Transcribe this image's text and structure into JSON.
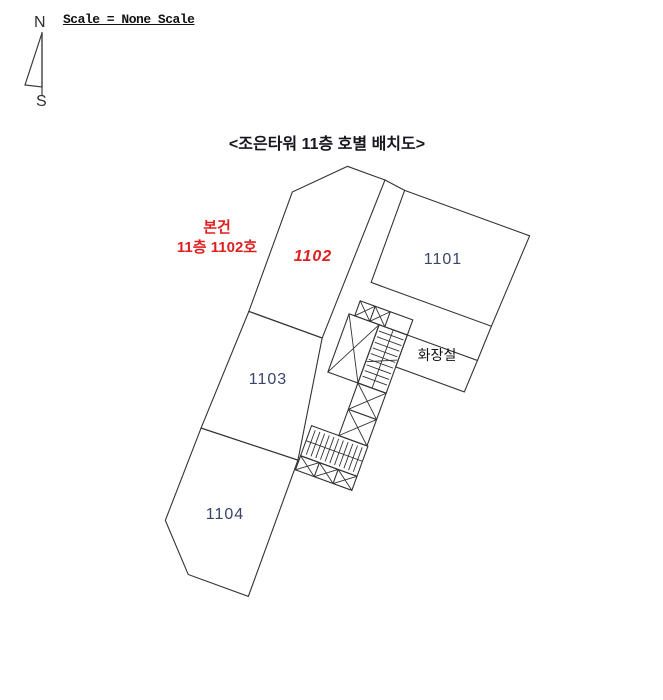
{
  "colors": {
    "line": "#333333",
    "hatch_red": "#e46060",
    "annotation_red": "#e01f1f",
    "unit_label": "#3a4469",
    "title_text": "#16161f",
    "text_dark": "#2f2f2f"
  },
  "header": {
    "scale_note": "Scale = None Scale",
    "title": "<조은타워 11층 호별 배치도>"
  },
  "compass": {
    "north": "N",
    "south": "S"
  },
  "annotation": {
    "line1": "본건",
    "line2": "11층 1102호"
  },
  "plan": {
    "units": [
      {
        "id": "1101",
        "label": "1101",
        "highlighted": false
      },
      {
        "id": "1102",
        "label": "1102",
        "highlighted": true
      },
      {
        "id": "1103",
        "label": "1103",
        "highlighted": false
      },
      {
        "id": "1104",
        "label": "1104",
        "highlighted": false
      }
    ],
    "restroom_label": "화장실"
  }
}
